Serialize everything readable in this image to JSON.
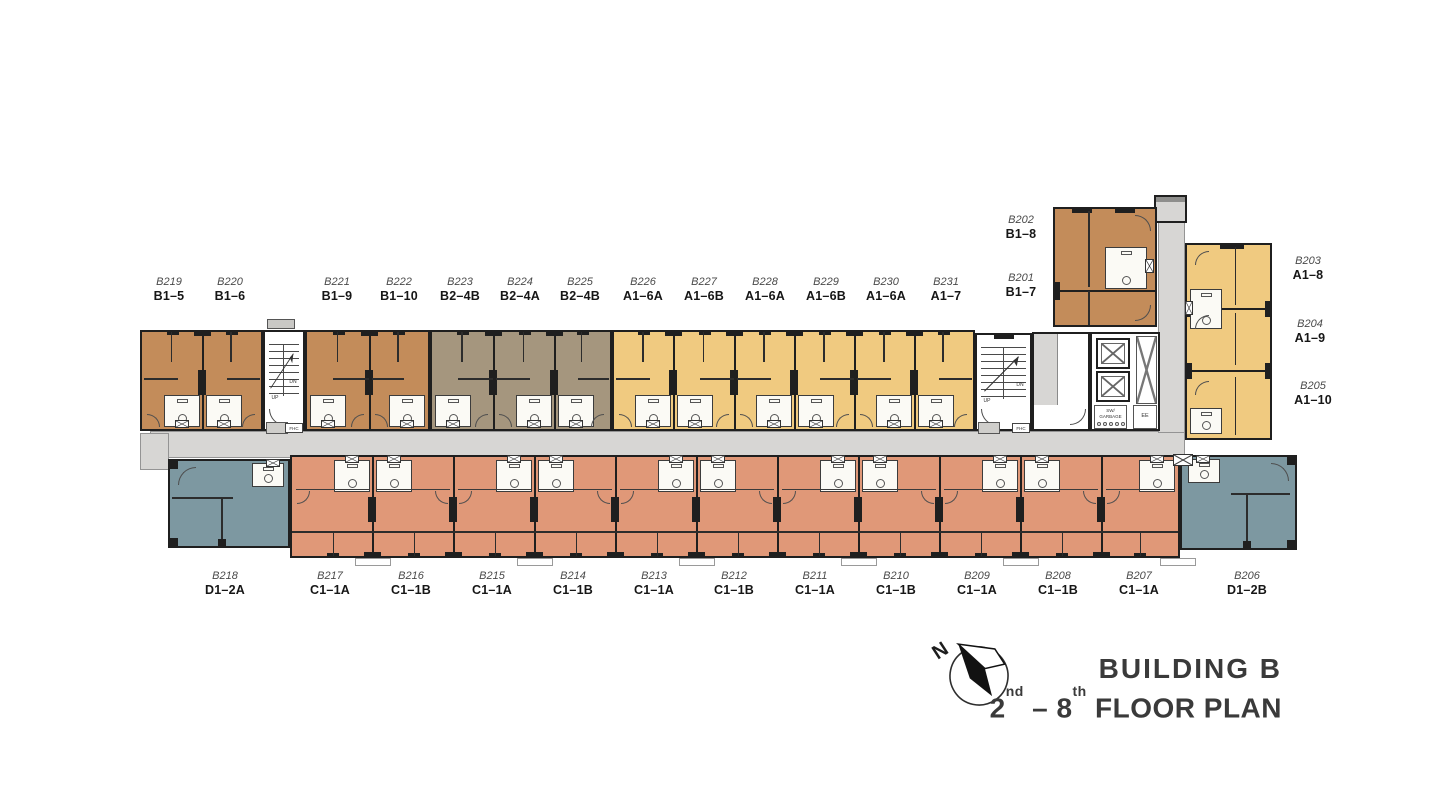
{
  "title": {
    "building": "BUILDING B",
    "floor_num1": "2",
    "floor_sup1": "nd",
    "floor_dash": " – ",
    "floor_num2": "8",
    "floor_sup2": "th",
    "floor_rest": " FLOOR PLAN"
  },
  "compass": {
    "label": "N"
  },
  "colors": {
    "brown": "#c38c5a",
    "taupe": "#a5967e",
    "yellow": "#f0ca80",
    "salmon": "#e09878",
    "teal": "#7d98a1",
    "corridor": "#d7d6d4",
    "wall": "#1f1f1f",
    "text": "#3a3a3a"
  },
  "core_labels": {
    "up": "UP",
    "dn": "DN",
    "fhc": "FHC",
    "sw1": "SW/",
    "sw2": "GARBAGE",
    "ee": "EE"
  },
  "units": {
    "top": [
      {
        "id": "B219",
        "type": "B1–5",
        "cx": 169
      },
      {
        "id": "B220",
        "type": "B1–6",
        "cx": 230
      },
      {
        "id": "B221",
        "type": "B1–9",
        "cx": 337
      },
      {
        "id": "B222",
        "type": "B1–10",
        "cx": 399
      },
      {
        "id": "B223",
        "type": "B2–4B",
        "cx": 460
      },
      {
        "id": "B224",
        "type": "B2–4A",
        "cx": 520
      },
      {
        "id": "B225",
        "type": "B2–4B",
        "cx": 580
      },
      {
        "id": "B226",
        "type": "A1–6A",
        "cx": 643
      },
      {
        "id": "B227",
        "type": "A1–6B",
        "cx": 704
      },
      {
        "id": "B228",
        "type": "A1–6A",
        "cx": 765
      },
      {
        "id": "B229",
        "type": "A1–6B",
        "cx": 826
      },
      {
        "id": "B230",
        "type": "A1–6A",
        "cx": 886
      },
      {
        "id": "B231",
        "type": "A1–7",
        "cx": 946
      }
    ],
    "corner_column": [
      {
        "id": "B202",
        "type": "B1–8",
        "cx": 1021,
        "cy": 214
      },
      {
        "id": "B201",
        "type": "B1–7",
        "cx": 1021,
        "cy": 272
      }
    ],
    "right": [
      {
        "id": "B203",
        "type": "A1–8",
        "cx": 1308,
        "cy": 255
      },
      {
        "id": "B204",
        "type": "A1–9",
        "cx": 1310,
        "cy": 318
      },
      {
        "id": "B205",
        "type": "A1–10",
        "cx": 1313,
        "cy": 380
      }
    ],
    "bottom": [
      {
        "id": "B218",
        "type": "D1–2A",
        "cx": 225
      },
      {
        "id": "B217",
        "type": "C1–1A",
        "cx": 330
      },
      {
        "id": "B216",
        "type": "C1–1B",
        "cx": 411
      },
      {
        "id": "B215",
        "type": "C1–1A",
        "cx": 492
      },
      {
        "id": "B214",
        "type": "C1–1B",
        "cx": 573
      },
      {
        "id": "B213",
        "type": "C1–1A",
        "cx": 654
      },
      {
        "id": "B212",
        "type": "C1–1B",
        "cx": 734
      },
      {
        "id": "B211",
        "type": "C1–1A",
        "cx": 815
      },
      {
        "id": "B210",
        "type": "C1–1B",
        "cx": 896
      },
      {
        "id": "B209",
        "type": "C1–1A",
        "cx": 977
      },
      {
        "id": "B208",
        "type": "C1–1B",
        "cx": 1058
      },
      {
        "id": "B207",
        "type": "C1–1A",
        "cx": 1139
      },
      {
        "id": "B206",
        "type": "D1–2B",
        "cx": 1247
      }
    ]
  },
  "label_rows": {
    "top_y": 276,
    "bottom_y": 570
  },
  "plan_geometry": {
    "corridors": [
      {
        "x": 150,
        "y": 431,
        "w": 1035,
        "h": 27
      },
      {
        "x": 1158,
        "y": 197,
        "w": 27,
        "h": 236
      },
      {
        "x": 140,
        "y": 433,
        "w": 29,
        "h": 37
      }
    ],
    "vestibule": {
      "x": 1154,
      "y": 195,
      "w": 33,
      "h": 28
    },
    "vent_boxes": [
      {
        "x": 1173,
        "y": 454,
        "w": 20,
        "h": 12
      }
    ],
    "blocks": [
      {
        "kind": "row",
        "x": 140,
        "y": 330,
        "w": 123,
        "h": 101,
        "color": "brown",
        "dividers": [
          61
        ],
        "baths": [
          "r",
          "l"
        ],
        "edge": "top"
      },
      {
        "kind": "stair",
        "x": 263,
        "y": 330,
        "w": 42,
        "h": 101,
        "topStub": true
      },
      {
        "kind": "row",
        "x": 305,
        "y": 330,
        "w": 125,
        "h": 101,
        "color": "brown",
        "dividers": [
          63
        ],
        "baths": [
          "l",
          "r"
        ],
        "edge": "top"
      },
      {
        "kind": "row",
        "x": 430,
        "y": 330,
        "w": 182,
        "h": 101,
        "color": "taupe",
        "dividers": [
          62,
          123
        ],
        "baths": [
          "l",
          "r",
          "l"
        ],
        "edge": "top"
      },
      {
        "kind": "row",
        "x": 612,
        "y": 330,
        "w": 363,
        "h": 101,
        "color": "yellow",
        "dividers": [
          60,
          121,
          181,
          241,
          301
        ],
        "baths": [
          "r",
          "l",
          "r",
          "l",
          "r",
          "l"
        ],
        "edge": "top"
      },
      {
        "kind": "stair",
        "x": 975,
        "y": 333,
        "w": 57,
        "h": 98,
        "topStub": false
      },
      {
        "kind": "lobby",
        "x": 1032,
        "y": 332,
        "w": 58,
        "h": 99
      },
      {
        "kind": "core",
        "x": 1090,
        "y": 332,
        "w": 70,
        "h": 99
      },
      {
        "kind": "corner",
        "x": 1053,
        "y": 207,
        "w": 104,
        "h": 120,
        "color": "brown",
        "divY": 82
      },
      {
        "kind": "stack",
        "x": 1185,
        "y": 243,
        "w": 87,
        "h": 197,
        "color": "yellow",
        "divYs": [
          64,
          126
        ]
      },
      {
        "kind": "end",
        "x": 168,
        "y": 459,
        "w": 122,
        "h": 89,
        "color": "teal",
        "side": "left"
      },
      {
        "kind": "row",
        "x": 290,
        "y": 455,
        "w": 890,
        "h": 103,
        "color": "salmon",
        "dividers": [
          81,
          162,
          243,
          324,
          405,
          486,
          567,
          648,
          729,
          810
        ],
        "baths": [
          "r",
          "l",
          "r",
          "l",
          "r",
          "l",
          "r",
          "l",
          "r",
          "l",
          "r"
        ],
        "edge": "bottom"
      },
      {
        "kind": "end",
        "x": 1180,
        "y": 455,
        "w": 117,
        "h": 95,
        "color": "teal",
        "side": "right"
      }
    ]
  }
}
